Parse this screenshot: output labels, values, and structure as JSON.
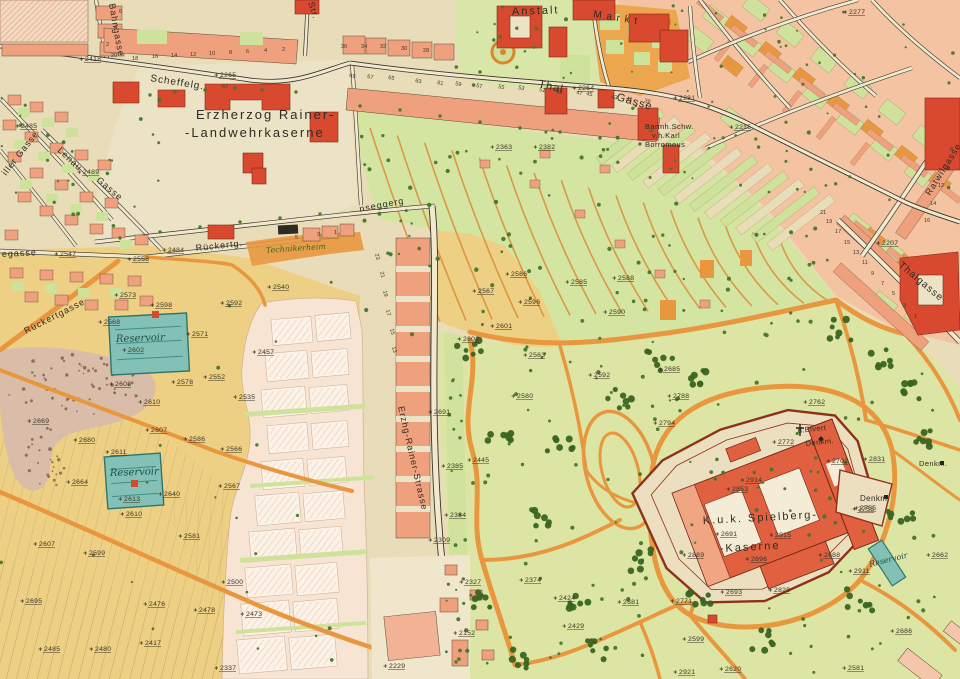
{
  "map": {
    "colors": {
      "paper": "#e9dcb8",
      "plaza": "#ece3c6",
      "roadc": "#f1e8cd",
      "line": "#3a352b",
      "salmon": "#efa07c",
      "salmon_light": "#f4c3a2",
      "red": "#d8492f",
      "park": "#dde5a4",
      "garden": "#cfe29c",
      "band": "#d4e5a2",
      "tree": "#47762a",
      "tree_dark": "#3a6422",
      "orange": "#e9973f",
      "orange_deep": "#d9862f",
      "yellow": "#edd084",
      "hatch": "#ad8d55",
      "teal": "#83c1b7",
      "teal_line": "#2f756b",
      "pink_zone": "#f7e4d3",
      "plot": "#fcf3e8",
      "plot_hatch": "#ecc0a8",
      "quarry": "#d9bda9",
      "quarry_dot": "#7e5c49",
      "fortress_red": "#e0603f",
      "fortress_light": "#f0a583",
      "fortress_line": "#8f3018",
      "ink": "#2f2b20"
    },
    "labels": [
      {
        "t": "Bahngasse",
        "x": 109,
        "y": 4,
        "r": 80,
        "fs": 9,
        "st": "s"
      },
      {
        "t": "Str.",
        "x": 308,
        "y": 3,
        "r": 72,
        "fs": 9,
        "st": "s"
      },
      {
        "t": "Scheffelg.",
        "x": 150,
        "y": 81,
        "r": 9,
        "fs": 10,
        "st": "s"
      },
      {
        "t": "Anstalt",
        "x": 512,
        "y": 15,
        "r": -2,
        "fs": 11,
        "st": "p"
      },
      {
        "t": "M a r k t",
        "x": 593,
        "y": 17,
        "r": 9,
        "fs": 10,
        "st": "s",
        "sp": 2
      },
      {
        "t": "Thal",
        "x": 538,
        "y": 87,
        "r": 13,
        "fs": 11,
        "st": "s",
        "sp": 4
      },
      {
        "t": "Gasse",
        "x": 616,
        "y": 100,
        "r": 16,
        "fs": 11,
        "st": "s",
        "sp": 4
      },
      {
        "t": "Erzherzog Rainer-",
        "x": 196,
        "y": 119,
        "r": 0,
        "fs": 13,
        "st": "p"
      },
      {
        "t": "-Landwehrkaserne",
        "x": 185,
        "y": 137,
        "r": 0,
        "fs": 13,
        "st": "p"
      },
      {
        "t": "iller Gasse",
        "x": 6,
        "y": 176,
        "r": -52,
        "fs": 9,
        "st": "s"
      },
      {
        "t": "Lenau",
        "x": 57,
        "y": 151,
        "r": 43,
        "fs": 9,
        "st": "s"
      },
      {
        "t": "Gasse",
        "x": 96,
        "y": 181,
        "r": 40,
        "fs": 9,
        "st": "s"
      },
      {
        "t": "egasse",
        "x": 2,
        "y": 257,
        "r": -3,
        "fs": 9,
        "st": "s"
      },
      {
        "t": "Rückertgasse",
        "x": 26,
        "y": 334,
        "r": -27,
        "fs": 9,
        "st": "s"
      },
      {
        "t": "Rückertg.",
        "x": 196,
        "y": 251,
        "r": -6,
        "fs": 9,
        "st": "s"
      },
      {
        "t": "Technikerheim",
        "x": 266,
        "y": 253,
        "r": -4,
        "fs": 8,
        "st": "g"
      },
      {
        "t": "nseggerg",
        "x": 360,
        "y": 212,
        "r": -11,
        "fs": 9,
        "st": "s"
      },
      {
        "t": "Reservoir",
        "x": 116,
        "y": 342,
        "r": -2,
        "fs": 10,
        "st": "i"
      },
      {
        "t": "Reservoir",
        "x": 110,
        "y": 476,
        "r": -2,
        "fs": 10,
        "st": "i"
      },
      {
        "t": "Erzhg-Rainer-Strasse",
        "x": 398,
        "y": 407,
        "r": 77,
        "fs": 9,
        "st": "s"
      },
      {
        "t": "Barmh.Schw.",
        "x": 645,
        "y": 129,
        "r": 0,
        "fs": 7.5,
        "st": "e"
      },
      {
        "t": "v.h.Karl",
        "x": 652,
        "y": 138,
        "r": 0,
        "fs": 7.5,
        "st": "e"
      },
      {
        "t": "Borromeus",
        "x": 645,
        "y": 147,
        "r": 0,
        "fs": 7.5,
        "st": "e"
      },
      {
        "t": "Ratwilgasse",
        "x": 930,
        "y": 196,
        "r": -58,
        "fs": 9,
        "st": "s"
      },
      {
        "t": "Thalgasse",
        "x": 898,
        "y": 266,
        "r": 40,
        "fs": 10,
        "st": "s"
      },
      {
        "t": "K.u.k. Spielberg-",
        "x": 703,
        "y": 524,
        "r": -3,
        "fs": 11,
        "st": "p"
      },
      {
        "t": "-Kaserne",
        "x": 720,
        "y": 552,
        "r": -3,
        "fs": 11,
        "st": "p"
      },
      {
        "t": "Denkm.",
        "x": 860,
        "y": 501,
        "r": 0,
        "fs": 8,
        "st": "e"
      },
      {
        "t": "d.Elvert",
        "x": 798,
        "y": 433,
        "r": -6,
        "fs": 7.5,
        "st": "e"
      },
      {
        "t": "Denkm.",
        "x": 806,
        "y": 446,
        "r": -6,
        "fs": 7.5,
        "st": "e"
      },
      {
        "t": "Denkm.",
        "x": 919,
        "y": 466,
        "r": 0,
        "fs": 7.5,
        "st": "e"
      },
      {
        "t": "Reservoir",
        "x": 870,
        "y": 567,
        "r": -14,
        "fs": 8,
        "st": "i"
      }
    ],
    "elevations": [
      [
        2418,
        85,
        61
      ],
      [
        2265,
        220,
        77
      ],
      [
        2485,
        21,
        128
      ],
      [
        2489,
        83,
        174
      ],
      [
        2547,
        60,
        256
      ],
      [
        2558,
        133,
        261
      ],
      [
        2484,
        168,
        252
      ],
      [
        2573,
        120,
        297
      ],
      [
        2568,
        104,
        324
      ],
      [
        2598,
        156,
        307
      ],
      [
        2592,
        226,
        305
      ],
      [
        2540,
        273,
        289
      ],
      [
        2571,
        192,
        336
      ],
      [
        2457,
        258,
        354
      ],
      [
        2578,
        177,
        384
      ],
      [
        2552,
        209,
        379
      ],
      [
        2608,
        115,
        386
      ],
      [
        2610,
        144,
        404
      ],
      [
        2535,
        239,
        399
      ],
      [
        2669,
        33,
        423
      ],
      [
        2680,
        79,
        442
      ],
      [
        2607,
        151,
        432
      ],
      [
        2586,
        189,
        441
      ],
      [
        2566,
        226,
        451
      ],
      [
        2611,
        111,
        454
      ],
      [
        2664,
        72,
        484
      ],
      [
        2613,
        124,
        501
      ],
      [
        2640,
        164,
        496
      ],
      [
        2567,
        224,
        488
      ],
      [
        2610,
        126,
        516
      ],
      [
        2581,
        184,
        538
      ],
      [
        2607,
        39,
        546
      ],
      [
        2599,
        89,
        555
      ],
      [
        2500,
        227,
        584
      ],
      [
        2695,
        26,
        603
      ],
      [
        2476,
        149,
        606
      ],
      [
        2478,
        199,
        612
      ],
      [
        2473,
        246,
        616
      ],
      [
        2485,
        44,
        651
      ],
      [
        2480,
        95,
        651
      ],
      [
        2417,
        145,
        645
      ],
      [
        2337,
        220,
        670
      ],
      [
        2691,
        434,
        414
      ],
      [
        2445,
        473,
        462
      ],
      [
        2385,
        447,
        468
      ],
      [
        2384,
        450,
        517
      ],
      [
        2309,
        434,
        542
      ],
      [
        2327,
        465,
        584
      ],
      [
        2374,
        525,
        582
      ],
      [
        2424,
        559,
        600
      ],
      [
        2429,
        568,
        628
      ],
      [
        2681,
        623,
        604
      ],
      [
        2152,
        459,
        635
      ],
      [
        2229,
        389,
        668
      ],
      [
        2567,
        478,
        293
      ],
      [
        2586,
        511,
        276
      ],
      [
        2596,
        524,
        304
      ],
      [
        2585,
        571,
        284
      ],
      [
        2588,
        618,
        280
      ],
      [
        2590,
        609,
        314
      ],
      [
        2601,
        496,
        328
      ],
      [
        2602,
        463,
        341
      ],
      [
        2563,
        529,
        357
      ],
      [
        2592,
        594,
        377
      ],
      [
        2580,
        517,
        398
      ],
      [
        2685,
        664,
        371
      ],
      [
        2788,
        673,
        398
      ],
      [
        2794,
        659,
        425
      ],
      [
        2762,
        809,
        404
      ],
      [
        2772,
        778,
        444
      ],
      [
        2702,
        832,
        463
      ],
      [
        2831,
        869,
        461
      ],
      [
        2914,
        746,
        482
      ],
      [
        2853,
        732,
        491
      ],
      [
        2755,
        860,
        510
      ],
      [
        2691,
        721,
        536
      ],
      [
        2915,
        775,
        537
      ],
      [
        2889,
        688,
        557
      ],
      [
        2696,
        751,
        561
      ],
      [
        2688,
        824,
        557
      ],
      [
        2911,
        854,
        573
      ],
      [
        2662,
        932,
        557
      ],
      [
        2829,
        774,
        592
      ],
      [
        2771,
        676,
        603
      ],
      [
        2693,
        726,
        594
      ],
      [
        2686,
        896,
        633
      ],
      [
        2599,
        688,
        641
      ],
      [
        2620,
        725,
        671
      ],
      [
        2581,
        848,
        670
      ],
      [
        2921,
        679,
        674
      ],
      [
        2281,
        679,
        100
      ],
      [
        2215,
        735,
        129
      ],
      [
        2277,
        849,
        14
      ],
      [
        2207,
        882,
        245
      ],
      [
        2264,
        578,
        90
      ],
      [
        2363,
        496,
        149
      ],
      [
        2382,
        539,
        149
      ],
      [
        2602,
        128,
        352
      ],
      [
        2755,
        858,
        511
      ]
    ],
    "house_numbers": [
      [
        "20",
        111,
        57,
        0
      ],
      [
        "18",
        132,
        60,
        0
      ],
      [
        "16",
        152,
        58,
        0
      ],
      [
        "14",
        171,
        57,
        0
      ],
      [
        "12",
        190,
        56,
        0
      ],
      [
        "10",
        209,
        55,
        0
      ],
      [
        "8",
        229,
        54,
        0
      ],
      [
        "6",
        246,
        53,
        0
      ],
      [
        "4",
        264,
        52,
        0
      ],
      [
        "2",
        282,
        51,
        0
      ],
      [
        "2",
        106,
        46,
        0
      ],
      [
        "4",
        114,
        29,
        0
      ],
      [
        "6",
        119,
        13,
        0
      ],
      [
        "36",
        341,
        48,
        0
      ],
      [
        "34",
        361,
        48,
        0
      ],
      [
        "32",
        380,
        48,
        0
      ],
      [
        "30",
        401,
        50,
        0
      ],
      [
        "28",
        423,
        52,
        0
      ],
      [
        "69",
        349,
        77,
        10
      ],
      [
        "67",
        367,
        78,
        10
      ],
      [
        "65",
        388,
        79,
        10
      ],
      [
        "63",
        415,
        82,
        12
      ],
      [
        "61",
        437,
        84,
        12
      ],
      [
        "59",
        455,
        85,
        12
      ],
      [
        "57",
        476,
        87,
        12
      ],
      [
        "55",
        498,
        88,
        12
      ],
      [
        "53",
        518,
        89,
        12
      ],
      [
        "51",
        539,
        91,
        12
      ],
      [
        "49",
        556,
        93,
        12
      ],
      [
        "47",
        576,
        94,
        12
      ],
      [
        "45",
        586,
        95,
        12
      ],
      [
        "43",
        611,
        98,
        14
      ],
      [
        "41",
        626,
        100,
        14
      ],
      [
        "39",
        644,
        102,
        14
      ],
      [
        "21",
        820,
        214,
        0
      ],
      [
        "19",
        826,
        223,
        0
      ],
      [
        "17",
        835,
        233,
        0
      ],
      [
        "15",
        844,
        244,
        0
      ],
      [
        "13",
        853,
        254,
        0
      ],
      [
        "11",
        862,
        264,
        0
      ],
      [
        "9",
        871,
        275,
        0
      ],
      [
        "7",
        881,
        285,
        0
      ],
      [
        "5",
        892,
        295,
        0
      ],
      [
        "3",
        903,
        307,
        0
      ],
      [
        "1",
        914,
        318,
        0
      ],
      [
        "8",
        950,
        151,
        0
      ],
      [
        "10",
        944,
        170,
        0
      ],
      [
        "12",
        938,
        187,
        0
      ],
      [
        "14",
        930,
        205,
        0
      ],
      [
        "16",
        924,
        222,
        0
      ],
      [
        "5",
        295,
        239,
        0
      ],
      [
        "3",
        317,
        236,
        0
      ],
      [
        "1",
        334,
        234,
        0
      ],
      [
        "23",
        375,
        254,
        76
      ],
      [
        "21",
        380,
        272,
        76
      ],
      [
        "19",
        383,
        291,
        76
      ],
      [
        "17",
        386,
        310,
        76
      ],
      [
        "15",
        390,
        329,
        76
      ],
      [
        "13",
        392,
        347,
        76
      ],
      [
        "67",
        222,
        88,
        0
      ]
    ]
  }
}
